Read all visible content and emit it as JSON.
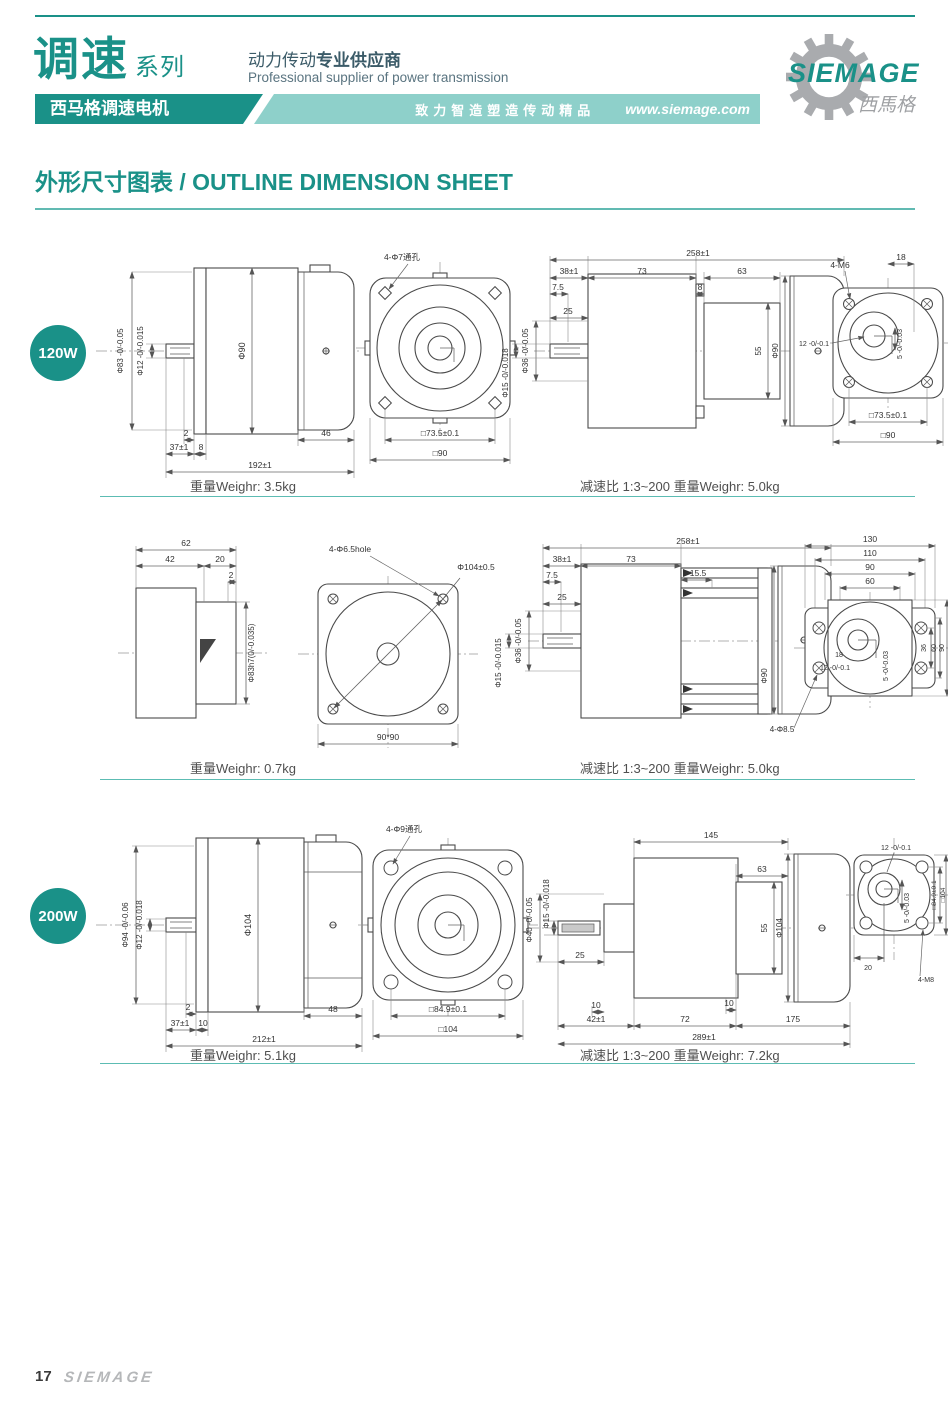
{
  "header": {
    "series_title": "调速",
    "series_suffix": "系列",
    "series_banner": "西马格调速电机",
    "supplier_cn_a": "动力传动",
    "supplier_cn_b": "专业供应商",
    "supplier_en": "Professional supplier of power transmission",
    "slogan": "致力智造塑造传动精品",
    "website": "www.siemage.com",
    "logo_text": "SIEMAGE",
    "logo_cn": "西馬格"
  },
  "page_title": "外形尺寸图表 / OUTLINE DIMENSION SHEET",
  "colors": {
    "teal": "#1a9188",
    "teal_light": "#8ed0ca"
  },
  "footer": {
    "page_number": "17",
    "brand": "SIEMAGE"
  },
  "sections": [
    {
      "badge": "120W",
      "motor_weight": "重量Weighr: 3.5kg",
      "gear_note": "减速比 1:3~200 重量Weighr: 5.0kg",
      "side": {
        "d_outer": "Φ83 -0/-0.05",
        "d_shaft": "Φ12 -0/-0.015",
        "d_body": "Φ90",
        "k2": "2",
        "k37": "37±1",
        "k8": "8",
        "k46": "46",
        "total": "192±1"
      },
      "front": {
        "holes": "4-Φ7通孔",
        "sq_inner": "□73.5±0.1",
        "sq_outer": "□90"
      },
      "gside": {
        "total": "258±1",
        "k38": "38±1",
        "k73": "73",
        "k63": "63",
        "k75": "7.5",
        "k8": "8",
        "k25": "25",
        "d36": "Φ36 -0/-0.05",
        "d15": "Φ15 -0/-0.018",
        "k55": "55",
        "d90": "Φ90"
      },
      "gfront": {
        "holes": "4-M6",
        "k18": "18",
        "k12": "12 -0/-0.1",
        "k5": "5 -0/-0.03",
        "sq_inner": "□73.5±0.1",
        "sq_outer": "□90"
      }
    },
    {
      "motor_weight": "重量Weighr: 0.7kg",
      "gear_note": "减速比 1:3~200 重量Weighr: 5.0kg",
      "side": {
        "k62": "62",
        "k42": "42",
        "k20": "20",
        "k2": "2",
        "d_boss": "Φ83h7(0/-0.035)"
      },
      "front": {
        "holes": "4-Φ6.5hole",
        "dia": "Φ104±0.5",
        "sq": "90*90"
      },
      "gside": {
        "total": "258±1",
        "k38": "38±1",
        "k73": "73",
        "k155": "15.5",
        "k75": "7.5",
        "k25": "25",
        "d36": "Φ36 -0/-0.05",
        "d15": "Φ15 -0/-0.015",
        "d90": "Φ90"
      },
      "gfront": {
        "k130": "130",
        "k110": "110",
        "k90": "90",
        "k60": "60",
        "k18": "18",
        "k12": "12 -0/-0.1",
        "k5": "5 -0/-0.03",
        "r36": "36",
        "r60": "60",
        "r90": "90",
        "holes": "4-Φ8.5"
      }
    },
    {
      "badge": "200W",
      "motor_weight": "重量Weighr: 5.1kg",
      "gear_note": "减速比 1:3~200 重量Weighr: 7.2kg",
      "side": {
        "d_outer": "Φ94 -0/-0.06",
        "d_shaft": "Φ12 -0/-0.018",
        "d_body": "Φ104",
        "k2": "2",
        "k37": "37±1",
        "k10": "10",
        "k48": "48",
        "total": "212±1"
      },
      "front": {
        "holes": "4-Φ9通孔",
        "sq_inner": "□84.9±0.1",
        "sq_outer": "□104"
      },
      "gside": {
        "d40": "Φ40 -0/-0.05",
        "d15": "Φ15 -0/-0.018",
        "k145": "145",
        "k63": "63",
        "k55": "55",
        "d104": "Φ104",
        "k25": "25",
        "k10a": "10",
        "k10b": "10",
        "k42": "42±1",
        "k72": "72",
        "k175": "175",
        "total": "289±1"
      },
      "gfront": {
        "k12": "12 -0/-0.1",
        "k5": "5 -0/-0.03",
        "sq_inner": "□84.9±0.1",
        "sq_outer": "□104",
        "k20": "20",
        "holes": "4-M8"
      }
    }
  ]
}
